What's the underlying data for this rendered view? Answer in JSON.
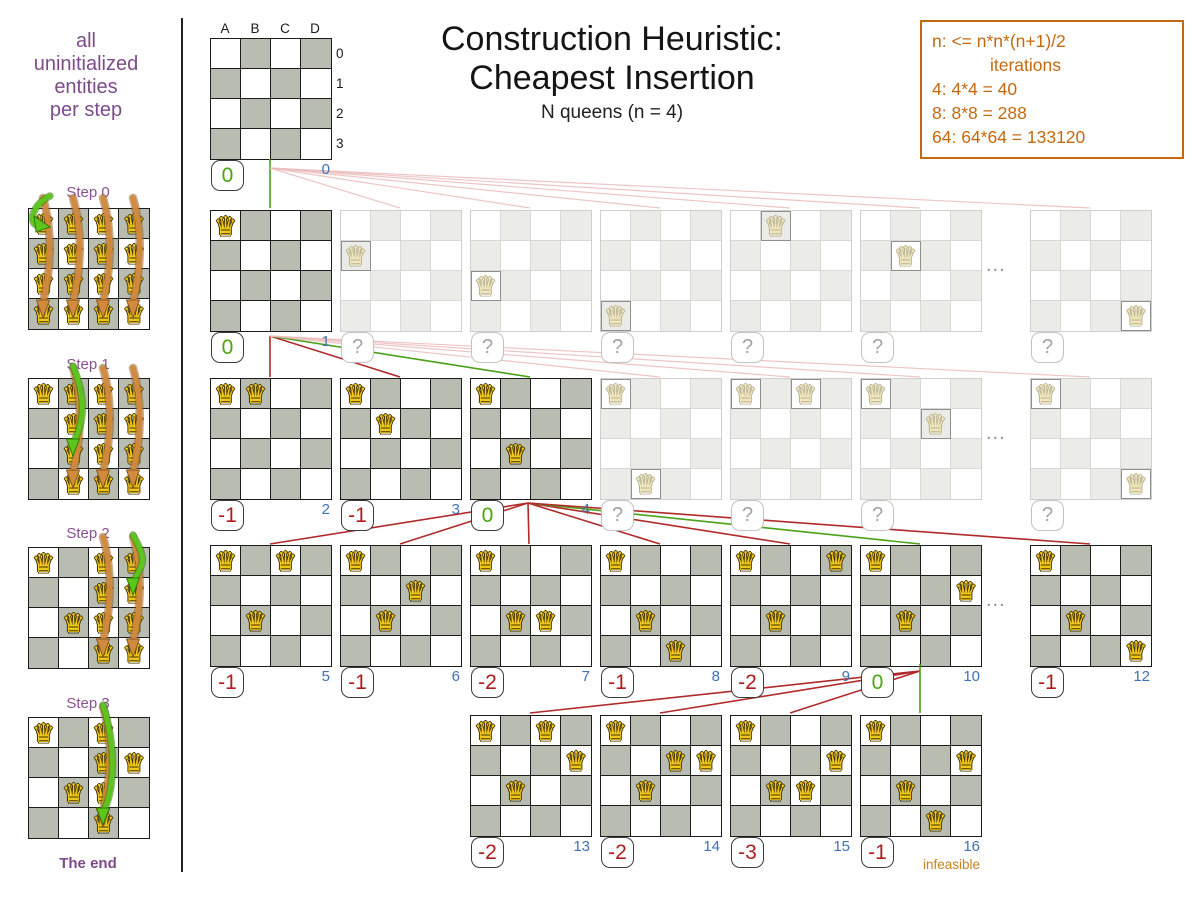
{
  "header": {
    "title1": "Construction Heuristic:",
    "title2": "Cheapest Insertion",
    "subtitle": "N queens (n = 4)"
  },
  "info_box": {
    "lines": [
      "n: <= n*n*(n+1)/2",
      "iterations",
      "4: 4*4 = 40",
      "8: 8*8 = 288",
      "64: 64*64 = 133120"
    ]
  },
  "sidebar": {
    "intro_lines": [
      "all",
      "uninitialized",
      "entities",
      "per step"
    ],
    "end_label": "The end",
    "x": 28,
    "steps": [
      {
        "label": "Step 0",
        "label_y": 184,
        "y": 208,
        "fixed": [],
        "full_cols": [
          0,
          1,
          2,
          3
        ],
        "orange_cols": [
          0,
          1,
          2,
          3
        ],
        "green": {
          "col": 0,
          "row": 0,
          "hook": true
        }
      },
      {
        "label": "Step 1",
        "label_y": 356,
        "y": 378,
        "fixed": [
          [
            0,
            0
          ]
        ],
        "full_cols": [
          1,
          2,
          3
        ],
        "orange_cols": [
          1,
          2,
          3
        ],
        "green": {
          "col": 1,
          "row": 2,
          "hook": false
        }
      },
      {
        "label": "Step 2",
        "label_y": 525,
        "y": 547,
        "fixed": [
          [
            0,
            0
          ],
          [
            1,
            2
          ]
        ],
        "full_cols": [
          2,
          3
        ],
        "orange_cols": [
          2,
          3
        ],
        "green": {
          "col": 3,
          "row": 1,
          "hook": false
        }
      },
      {
        "label": "Step 3",
        "label_y": 695,
        "y": 717,
        "fixed": [
          [
            0,
            0
          ],
          [
            1,
            2
          ],
          [
            3,
            1
          ]
        ],
        "full_cols": [
          2
        ],
        "orange_cols": [
          2
        ],
        "green": {
          "col": 2,
          "row": 3,
          "hook": false
        }
      }
    ]
  },
  "root": {
    "x": 210,
    "y": 38,
    "col_labels": [
      "A",
      "B",
      "C",
      "D"
    ],
    "row_labels": [
      "0",
      "1",
      "2",
      "3"
    ],
    "score": "0",
    "kind": "good",
    "iter": "0"
  },
  "rows": [
    {
      "y": 210,
      "dots_x": 992,
      "boards": [
        {
          "x": 210,
          "faded": false,
          "queens": [
            [
              0,
              0
            ]
          ],
          "score": "0",
          "kind": "good",
          "iter": "1"
        },
        {
          "x": 340,
          "faded": true,
          "queens": [
            [
              0,
              1
            ]
          ],
          "score": "?"
        },
        {
          "x": 470,
          "faded": true,
          "queens": [
            [
              0,
              2
            ]
          ],
          "score": "?"
        },
        {
          "x": 600,
          "faded": true,
          "queens": [
            [
              0,
              3
            ]
          ],
          "score": "?"
        },
        {
          "x": 730,
          "faded": true,
          "queens": [
            [
              1,
              0
            ]
          ],
          "score": "?"
        },
        {
          "x": 860,
          "faded": true,
          "queens": [
            [
              1,
              1
            ]
          ],
          "score": "?"
        },
        {
          "x": 1030,
          "faded": true,
          "queens": [
            [
              3,
              3
            ]
          ],
          "score": "?"
        }
      ]
    },
    {
      "y": 378,
      "dots_x": 992,
      "boards": [
        {
          "x": 210,
          "faded": false,
          "queens": [
            [
              0,
              0
            ],
            [
              1,
              0
            ]
          ],
          "score": "-1",
          "kind": "bad",
          "iter": "2"
        },
        {
          "x": 340,
          "faded": false,
          "queens": [
            [
              0,
              0
            ],
            [
              1,
              1
            ]
          ],
          "score": "-1",
          "kind": "bad",
          "iter": "3"
        },
        {
          "x": 470,
          "faded": false,
          "queens": [
            [
              0,
              0
            ],
            [
              1,
              2
            ]
          ],
          "score": "0",
          "kind": "good",
          "iter": "4"
        },
        {
          "x": 600,
          "faded": true,
          "queens": [
            [
              0,
              0
            ],
            [
              1,
              3
            ]
          ],
          "score": "?"
        },
        {
          "x": 730,
          "faded": true,
          "queens": [
            [
              0,
              0
            ],
            [
              2,
              0
            ]
          ],
          "score": "?"
        },
        {
          "x": 860,
          "faded": true,
          "queens": [
            [
              0,
              0
            ],
            [
              2,
              1
            ]
          ],
          "score": "?"
        },
        {
          "x": 1030,
          "faded": true,
          "queens": [
            [
              0,
              0
            ],
            [
              3,
              3
            ]
          ],
          "score": "?"
        }
      ]
    },
    {
      "y": 545,
      "dots_x": 992,
      "boards": [
        {
          "x": 210,
          "faded": false,
          "queens": [
            [
              0,
              0
            ],
            [
              2,
              0
            ],
            [
              1,
              2
            ]
          ],
          "score": "-1",
          "kind": "bad",
          "iter": "5"
        },
        {
          "x": 340,
          "faded": false,
          "queens": [
            [
              0,
              0
            ],
            [
              2,
              1
            ],
            [
              1,
              2
            ]
          ],
          "score": "-1",
          "kind": "bad",
          "iter": "6"
        },
        {
          "x": 470,
          "faded": false,
          "queens": [
            [
              0,
              0
            ],
            [
              1,
              2
            ],
            [
              2,
              2
            ]
          ],
          "score": "-2",
          "kind": "bad",
          "iter": "7"
        },
        {
          "x": 600,
          "faded": false,
          "queens": [
            [
              0,
              0
            ],
            [
              1,
              2
            ],
            [
              2,
              3
            ]
          ],
          "score": "-1",
          "kind": "bad",
          "iter": "8"
        },
        {
          "x": 730,
          "faded": false,
          "queens": [
            [
              0,
              0
            ],
            [
              3,
              0
            ],
            [
              1,
              2
            ]
          ],
          "score": "-2",
          "kind": "bad",
          "iter": "9"
        },
        {
          "x": 860,
          "faded": false,
          "queens": [
            [
              0,
              0
            ],
            [
              3,
              1
            ],
            [
              1,
              2
            ]
          ],
          "score": "0",
          "kind": "good",
          "iter": "10"
        },
        {
          "x": 1030,
          "faded": false,
          "queens": [
            [
              0,
              0
            ],
            [
              1,
              2
            ],
            [
              3,
              3
            ]
          ],
          "score": "-1",
          "kind": "bad",
          "iter": "12"
        }
      ]
    },
    {
      "y": 715,
      "dots_x": null,
      "boards": [
        {
          "x": 470,
          "faded": false,
          "queens": [
            [
              0,
              0
            ],
            [
              2,
              0
            ],
            [
              3,
              1
            ],
            [
              1,
              2
            ]
          ],
          "score": "-2",
          "kind": "bad",
          "iter": "13"
        },
        {
          "x": 600,
          "faded": false,
          "queens": [
            [
              0,
              0
            ],
            [
              2,
              1
            ],
            [
              3,
              1
            ],
            [
              1,
              2
            ]
          ],
          "score": "-2",
          "kind": "bad",
          "iter": "14"
        },
        {
          "x": 730,
          "faded": false,
          "queens": [
            [
              0,
              0
            ],
            [
              3,
              1
            ],
            [
              1,
              2
            ],
            [
              2,
              2
            ]
          ],
          "score": "-3",
          "kind": "bad",
          "iter": "15"
        },
        {
          "x": 860,
          "faded": false,
          "queens": [
            [
              0,
              0
            ],
            [
              3,
              1
            ],
            [
              1,
              2
            ],
            [
              2,
              3
            ]
          ],
          "score": "-1",
          "kind": "bad",
          "iter": "16"
        }
      ]
    }
  ],
  "edges": [
    {
      "x1": 270,
      "y1": 159,
      "x2": 270,
      "y2": 208,
      "kind": "green"
    },
    {
      "x1": 270,
      "y1": 168,
      "x2": 400,
      "y2": 208,
      "kind": "pink"
    },
    {
      "x1": 270,
      "y1": 168,
      "x2": 530,
      "y2": 208,
      "kind": "pink"
    },
    {
      "x1": 270,
      "y1": 168,
      "x2": 660,
      "y2": 208,
      "kind": "pink"
    },
    {
      "x1": 270,
      "y1": 168,
      "x2": 790,
      "y2": 208,
      "kind": "pink"
    },
    {
      "x1": 270,
      "y1": 168,
      "x2": 920,
      "y2": 208,
      "kind": "pink"
    },
    {
      "x1": 270,
      "y1": 168,
      "x2": 1090,
      "y2": 208,
      "kind": "pink"
    },
    {
      "x1": 270,
      "y1": 336,
      "x2": 270,
      "y2": 377,
      "kind": "red"
    },
    {
      "x1": 270,
      "y1": 336,
      "x2": 400,
      "y2": 377,
      "kind": "red"
    },
    {
      "x1": 270,
      "y1": 336,
      "x2": 530,
      "y2": 377,
      "kind": "green"
    },
    {
      "x1": 270,
      "y1": 336,
      "x2": 660,
      "y2": 377,
      "kind": "pink"
    },
    {
      "x1": 270,
      "y1": 336,
      "x2": 790,
      "y2": 377,
      "kind": "pink"
    },
    {
      "x1": 270,
      "y1": 336,
      "x2": 920,
      "y2": 377,
      "kind": "pink"
    },
    {
      "x1": 270,
      "y1": 336,
      "x2": 1090,
      "y2": 377,
      "kind": "pink"
    },
    {
      "x1": 528,
      "y1": 503,
      "x2": 270,
      "y2": 544,
      "kind": "red"
    },
    {
      "x1": 528,
      "y1": 503,
      "x2": 400,
      "y2": 544,
      "kind": "red"
    },
    {
      "x1": 528,
      "y1": 503,
      "x2": 529,
      "y2": 544,
      "kind": "red"
    },
    {
      "x1": 528,
      "y1": 503,
      "x2": 660,
      "y2": 544,
      "kind": "red"
    },
    {
      "x1": 528,
      "y1": 503,
      "x2": 790,
      "y2": 544,
      "kind": "red"
    },
    {
      "x1": 528,
      "y1": 503,
      "x2": 920,
      "y2": 544,
      "kind": "green"
    },
    {
      "x1": 528,
      "y1": 503,
      "x2": 1090,
      "y2": 544,
      "kind": "red"
    },
    {
      "x1": 920,
      "y1": 671,
      "x2": 530,
      "y2": 713,
      "kind": "red"
    },
    {
      "x1": 920,
      "y1": 671,
      "x2": 660,
      "y2": 713,
      "kind": "red"
    },
    {
      "x1": 920,
      "y1": 671,
      "x2": 790,
      "y2": 713,
      "kind": "red"
    },
    {
      "x1": 920,
      "y1": 664,
      "x2": 920,
      "y2": 713,
      "kind": "green"
    }
  ],
  "labels": {
    "infeasible": "infeasible",
    "dots": "..."
  },
  "glyphs": {
    "queen": "♛"
  },
  "colors": {
    "good_score": "#4ea411",
    "bad_score": "#b01c1c",
    "iteration": "#4170b4",
    "purple_text": "#7d4b8a",
    "orange_text": "#c4690f",
    "green_line": "#4aa017",
    "red_line": "#b12a2a",
    "pink_line": "#ecbcbc",
    "cell_dark": "#b9bcb1",
    "faded_cell_dark": "#ebebe8",
    "queen_gold": "#f2c71b",
    "arrow_orange": "#d28a3e",
    "arrow_green": "#5cc61d"
  }
}
